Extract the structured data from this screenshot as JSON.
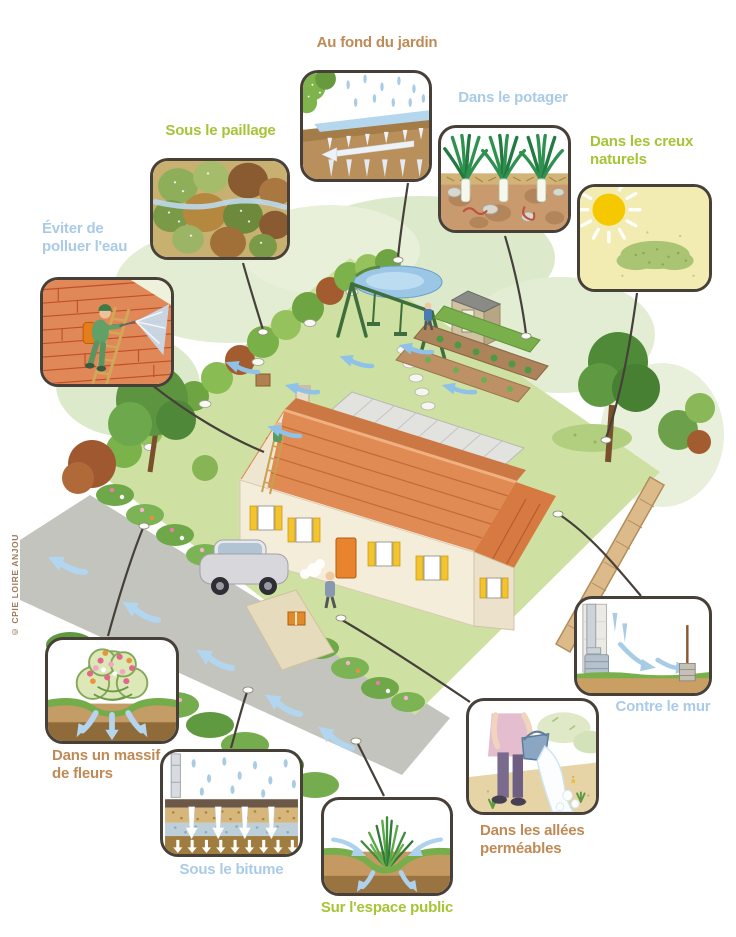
{
  "copyright": "© CPIE LOIRE ANJOU",
  "colors": {
    "label_brown": "#bf8a55",
    "label_green": "#a5c436",
    "label_blue": "#a9cbe8",
    "bubble_border": "#474038",
    "connector_line": "#46403a",
    "lawn_green": "#cfe1a2",
    "roof_orange": "#e08a54",
    "water_blue": "#a9cce6"
  },
  "callouts": [
    {
      "label": "Au fond du jardin",
      "color": "brown",
      "icon": "rain-infiltration-icon"
    },
    {
      "label": "Sous le paillage",
      "color": "green",
      "icon": "mulch-icon"
    },
    {
      "label": "Dans le potager",
      "color": "blue",
      "icon": "leeks-soil-icon"
    },
    {
      "label": "Dans les creux naturels",
      "color": "green",
      "icon": "sun-grass-hollow-icon"
    },
    {
      "label": "Éviter de polluer l'eau",
      "color": "blue",
      "icon": "roof-spraying-icon"
    },
    {
      "label": "Contre le mur",
      "color": "blue",
      "icon": "downspout-wall-icon"
    },
    {
      "label": "Dans un massif de fleurs",
      "color": "brown",
      "icon": "flower-bed-icon"
    },
    {
      "label": "Sous le bitume",
      "color": "blue",
      "icon": "asphalt-layers-icon"
    },
    {
      "label": "Sur l'espace public",
      "color": "green",
      "icon": "grass-swale-icon"
    },
    {
      "label": "Dans les allées perméables",
      "color": "brown",
      "icon": "watering-path-icon"
    }
  ]
}
